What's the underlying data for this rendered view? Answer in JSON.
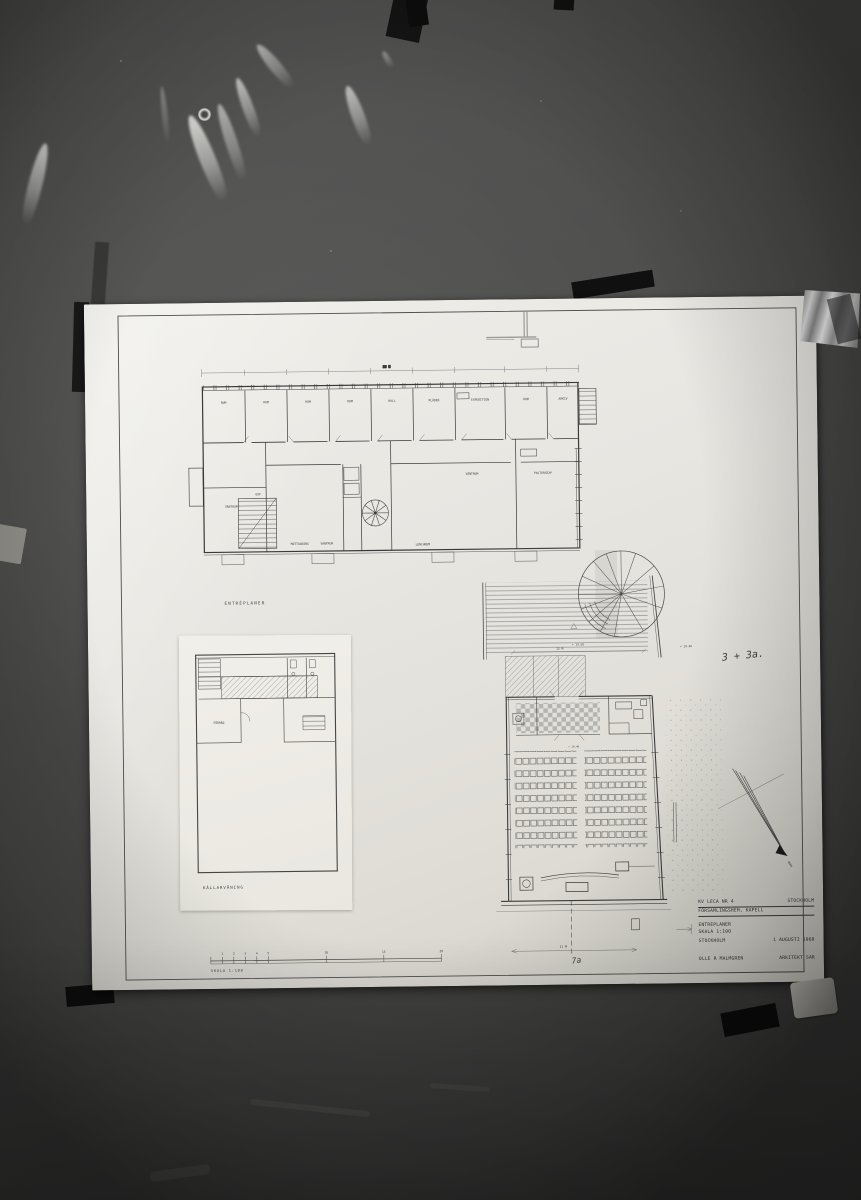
{
  "scene": {
    "colors": {
      "wall": "#4a4a49",
      "paper": "#e7e5e0",
      "ink": "#3a3a3a",
      "pencil": "#9b9b97"
    }
  },
  "sheet": {
    "plan_labels": {
      "upper": "ENTRÉPLANER",
      "basement": "KÄLLARVÅNING"
    },
    "upper_rooms": [
      "RUM",
      "RUM",
      "RUM",
      "RUM",
      "HALL",
      "KLÄDER",
      "EXPEDITION",
      "RUM",
      "ARKIV"
    ],
    "lower_rooms": [
      "VÄNTRUM",
      "PASTORSEXP",
      "VÄNTRUM",
      "EXP",
      "MOTTAGNING",
      "VÄNTRUM",
      "LUNCHRUM"
    ],
    "basement_rooms": [
      "FÖRRÅD"
    ],
    "annotations": {
      "handwritten_note": "3 + 3a.",
      "handwritten_mark": "7a",
      "dim_top": "35 M",
      "dim_courtyard": "12 M",
      "dim_bottom": "11 M",
      "level_terrace_left": "+ 19.50",
      "level_terrace_right": "+ 19.40",
      "level_nave": "+ 19.40",
      "north_label": "NORR"
    },
    "title_block": {
      "project": "KV LECA NR 4",
      "city": "STOCKHOLM",
      "subtitle": "FÖRSAMLINGSHEM, KAPELL",
      "sheet_name": "ENTREPLANER",
      "scale": "SKALA 1:100",
      "place": "STOCKHOLM",
      "date": "1 AUGUSTI 1960",
      "architect": "OLLE R MALMGREN",
      "architect_title": "ARKITEKT SAR"
    },
    "scale_bar": {
      "ticks": [
        "1",
        "2",
        "3",
        "4",
        "5",
        "10",
        "15",
        "20"
      ],
      "caption": "SKALA 1:100"
    }
  }
}
